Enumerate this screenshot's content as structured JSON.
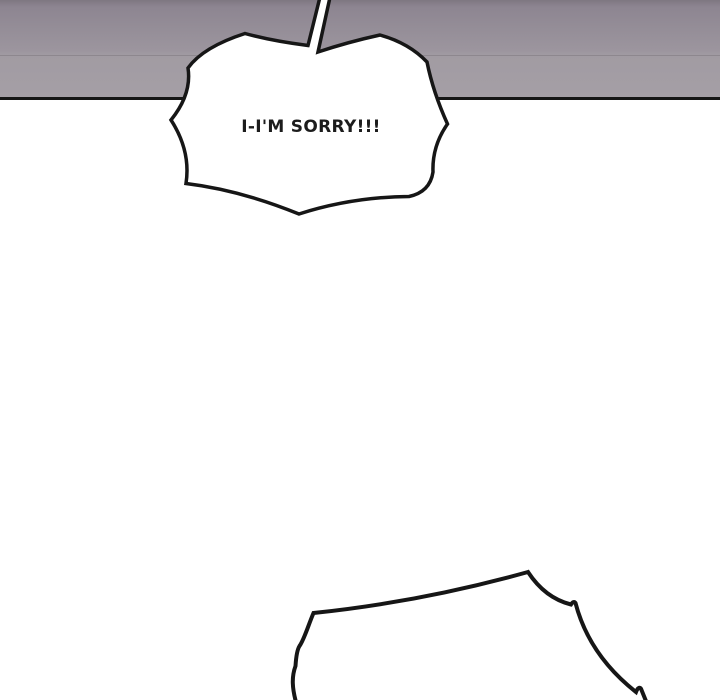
{
  "page": {
    "width": 720,
    "height": 700,
    "background": "#ffffff"
  },
  "panel": {
    "kind": "comic-panel",
    "backdrop_color_top": "#8d8591",
    "backdrop_color_bottom": "#a59fa6",
    "border_color": "#161616"
  },
  "speech_bubble": {
    "text": "I-I'M SORRY!!!",
    "shape": "spiky-shout-burst",
    "fill": "#ffffff",
    "stroke": "#161616"
  },
  "bottom_bubble": {
    "shape": "spiky-shout-burst-partial",
    "fill": "#ffffff",
    "stroke": "#161616"
  },
  "colors": {
    "ink": "#161616",
    "paper": "#ffffff"
  }
}
